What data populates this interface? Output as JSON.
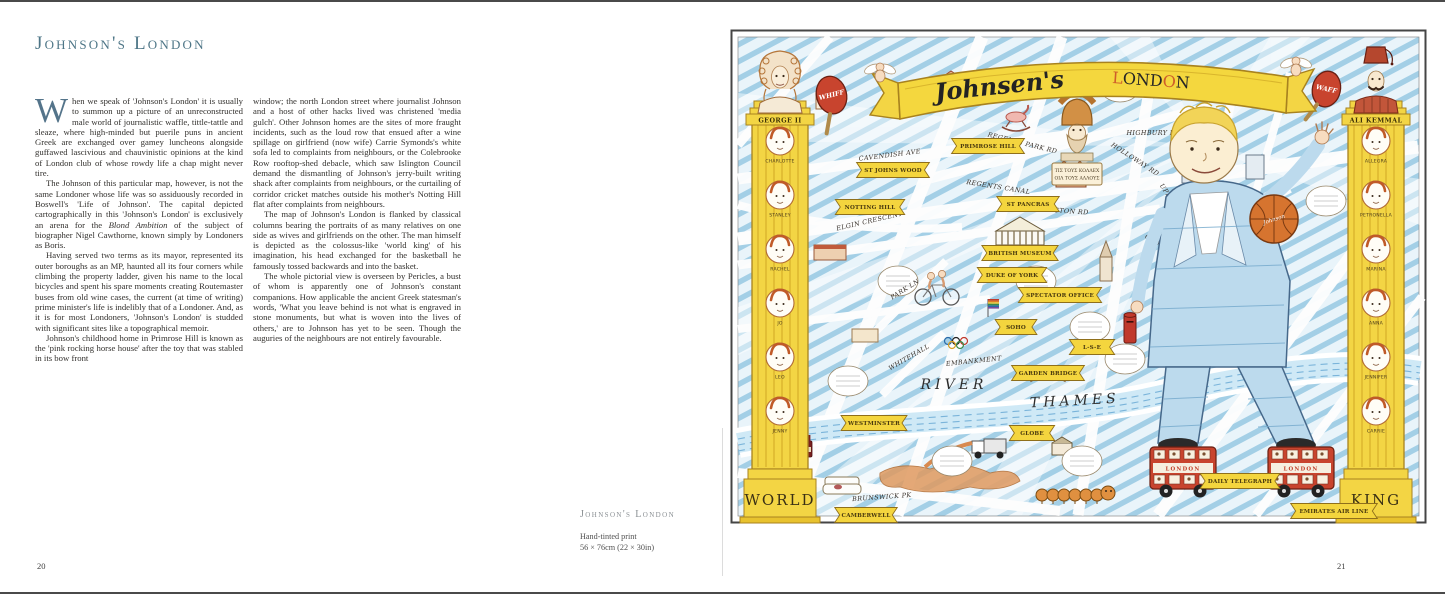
{
  "left_page": {
    "page_number": "20",
    "title": "Johnson's London",
    "dropcap": "W",
    "col1_p1": "hen we speak of 'Johnson's London' it is usually to summon up a picture of an unreconstructed male world of journalistic waffle, tittle-tattle and sleaze, where high-minded but puerile puns in ancient Greek are exchanged over gamey luncheons alongside guffawed lascivious and chauvinistic opinions at the kind of London club of whose rowdy life a chap might never tire.",
    "col1_p2_pre": "The Johnson of this particular map, however, is not the same Londoner whose life was so assiduously recorded in Boswell's 'Life of Johnson'. The capital depicted cartographically in this 'Johnson's London' is exclusively an arena for the ",
    "col1_p2_italic": "Blond Ambition",
    "col1_p2_post": " of the subject of biographer Nigel Cawthorne, known simply by Londoners as Boris.",
    "col1_p3": "Having served two terms as its mayor, represented its outer boroughs as an MP, haunted all its four corners while climbing the property ladder, given his name to the local bicycles and spent his spare moments creating Routemaster buses from old wine cases, the current (at time of writing) prime minister's life is indelibly that of a Londoner. And, as it is for most Londoners, 'Johnson's London' is studded with significant sites like a topographical memoir.",
    "col1_p4": "Johnson's childhood home in Primrose Hill is known as the 'pink rocking horse house' after the toy that was stabled in its bow front",
    "col2_p1": "window; the north London street where journalist Johnson and a host of other hacks lived was christened 'media gulch'. Other Johnson homes are the sites of more fraught incidents, such as the loud row that ensued after a wine spillage on girlfriend (now wife) Carrie Symonds's white sofa led to complaints from neighbours, or the Colebrooke Row rooftop-shed debacle, which saw Islington Council demand the dismantling of Johnson's jerry-built writing shack after complaints from neighbours, or the curtailing of corridor cricket matches outside his mother's Notting Hill flat after complaints from neighbours.",
    "col2_p2": "The map of Johnson's London is flanked by classical columns bearing the portraits of as many relatives on one side as wives and girlfriends on the other. The man himself is depicted as the colossus-like 'world king' of his imagination, his head exchanged for the basketball he famously tossed backwards and into the basket.",
    "col2_p3": "The whole pictorial view is overseen by Pericles, a bust of whom is apparently one of Johnson's constant companions. How applicable the ancient Greek statesman's words, 'What you leave behind is not what is engraved in stone monuments, but what is woven into the lives of others,' are to Johnson has yet to be seen. Though the auguries of the neighbours are not entirely favourable.",
    "caption": {
      "title": "Johnson's London",
      "medium": "Hand-tinted print",
      "size": "56 × 76cm (22 × 30in)"
    }
  },
  "right_page": {
    "page_number": "21"
  },
  "map": {
    "banner": {
      "script": "Johnsen's",
      "caps": "LONDON"
    },
    "left_column": {
      "bust": "GEORGE II",
      "base": "WORLD",
      "paddle": "WHIFF",
      "medallions": [
        "CHARLOTTE",
        "STANLEY",
        "RACHEL",
        "JO",
        "LEO",
        "JENNY"
      ]
    },
    "right_column": {
      "bust": "ALI KEMMAL",
      "base": "KING",
      "paddle": "WAFF",
      "medallions": [
        "ALLEGRA",
        "PETRONELLA",
        "MARINA",
        "ANNA",
        "JENNIFER",
        "CARRIE"
      ]
    },
    "colossus": {
      "ball_label": "Johnson"
    },
    "bus_label": "LONDON",
    "river": [
      "RIVER",
      "THAMES"
    ],
    "pericles_sign": [
      "ΤΙΣ ΤΟΥΣ ΚΟΛΛΕΧ",
      "ΟΙΛ ΤΟΥΣ ΑΛΛΟΥΣ"
    ],
    "streets": [
      {
        "t": "CAVENDISH AVE",
        "x": 160,
        "y": 128,
        "r": -7
      },
      {
        "t": "REGENTS PARK RD",
        "x": 292,
        "y": 116,
        "r": 14
      },
      {
        "t": "REGENTS CANAL",
        "x": 268,
        "y": 160,
        "r": 9
      },
      {
        "t": "EUSTON RD",
        "x": 336,
        "y": 184,
        "r": 4
      },
      {
        "t": "ELGIN CRESCENT",
        "x": 140,
        "y": 194,
        "r": -13
      },
      {
        "t": "HOLLOWAY RD",
        "x": 404,
        "y": 132,
        "r": 33
      },
      {
        "t": "HIGHBURY FIELDS",
        "x": 432,
        "y": 106,
        "r": 0
      },
      {
        "t": "UPPER ST",
        "x": 440,
        "y": 172,
        "r": 56
      },
      {
        "t": "CITY RD",
        "x": 428,
        "y": 216,
        "r": 28
      },
      {
        "t": "GOSWELL RD",
        "x": 482,
        "y": 252,
        "r": 72
      },
      {
        "t": "PARK LN",
        "x": 176,
        "y": 262,
        "r": -32
      },
      {
        "t": "WHITEHALL",
        "x": 180,
        "y": 330,
        "r": -30
      },
      {
        "t": "EMBANKMENT",
        "x": 244,
        "y": 334,
        "r": -6
      },
      {
        "t": "BRUNSWICK PK",
        "x": 152,
        "y": 470,
        "r": -4
      }
    ],
    "ribbons": [
      {
        "t": "ST JOHNS WOOD",
        "x": 163,
        "y": 141
      },
      {
        "t": "PRIMROSE HILL",
        "x": 258,
        "y": 117
      },
      {
        "t": "NOTTING HILL",
        "x": 140,
        "y": 178
      },
      {
        "t": "ST PANCRAS",
        "x": 298,
        "y": 175
      },
      {
        "t": "BRITISH MUSEUM",
        "x": 290,
        "y": 224
      },
      {
        "t": "DUKE OF YORK",
        "x": 282,
        "y": 246
      },
      {
        "t": "SPECTATOR OFFICE",
        "x": 330,
        "y": 266
      },
      {
        "t": "SOHO",
        "x": 286,
        "y": 298
      },
      {
        "t": "L-S-E",
        "x": 362,
        "y": 318
      },
      {
        "t": "GARDEN BRIDGE",
        "x": 318,
        "y": 344
      },
      {
        "t": "WESTMINSTER",
        "x": 144,
        "y": 394
      },
      {
        "t": "GLOBE",
        "x": 302,
        "y": 404
      },
      {
        "t": "CAMBERWELL",
        "x": 136,
        "y": 486
      },
      {
        "t": "DAILY TELEGRAPH",
        "x": 510,
        "y": 452
      },
      {
        "t": "EMIRATES AIR LINE",
        "x": 604,
        "y": 482
      }
    ],
    "bubbles": [
      [
        255,
        60
      ],
      [
        390,
        58
      ],
      [
        596,
        172
      ],
      [
        168,
        252
      ],
      [
        306,
        252
      ],
      [
        360,
        298
      ],
      [
        118,
        352
      ],
      [
        222,
        432
      ],
      [
        352,
        432
      ],
      [
        395,
        330
      ]
    ]
  }
}
